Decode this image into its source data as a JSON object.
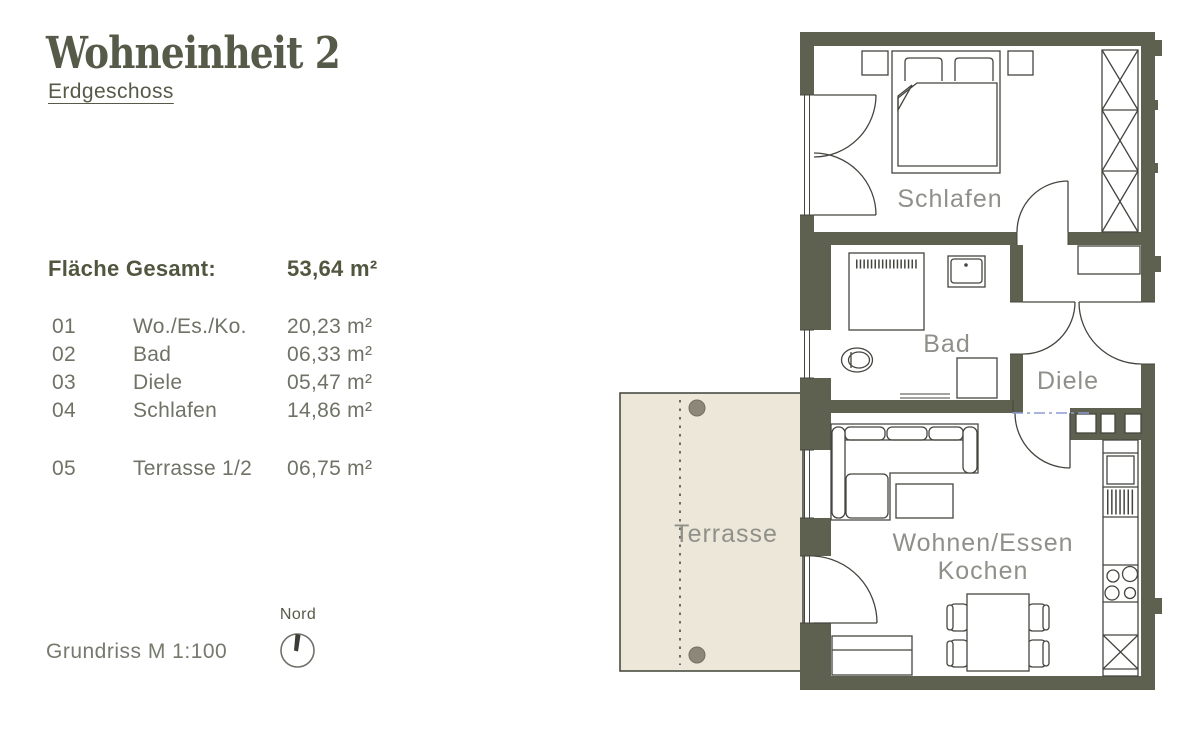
{
  "title": "Wohneinheit 2",
  "subtitle": "Erdgeschoss",
  "area_table": {
    "total_label": "Fläche Gesamt:",
    "total_value": "53,64 m²",
    "rows": [
      {
        "num": "01",
        "name": "Wo./Es./Ko.",
        "area": "20,23 m²"
      },
      {
        "num": "02",
        "name": "Bad",
        "area": "06,33 m²"
      },
      {
        "num": "03",
        "name": "Diele",
        "area": "05,47 m²"
      },
      {
        "num": "04",
        "name": "Schlafen",
        "area": "14,86 m²"
      },
      {
        "num": "05",
        "name": "Terrasse 1/2",
        "area": "06,75 m²"
      }
    ]
  },
  "footer": {
    "scale_label": "Grundriss M 1:100",
    "north_label": "Nord"
  },
  "plan": {
    "labels": {
      "schlafen": "Schlafen",
      "bad": "Bad",
      "diele": "Diele",
      "wohnen_line1": "Wohnen/Essen",
      "wohnen_line2": "Kochen",
      "terrasse": "Terrasse"
    }
  },
  "colors": {
    "wall": "#5e614f",
    "terrace_fill": "#ece7d8",
    "post": "#8d8779",
    "line": "#45453f",
    "label": "#90908a",
    "accent_text": "#565a49",
    "header_text": "#51563f",
    "row_text": "#6f7366",
    "footer_text": "#767a6d",
    "blue_marker": "#8f9cd4"
  }
}
